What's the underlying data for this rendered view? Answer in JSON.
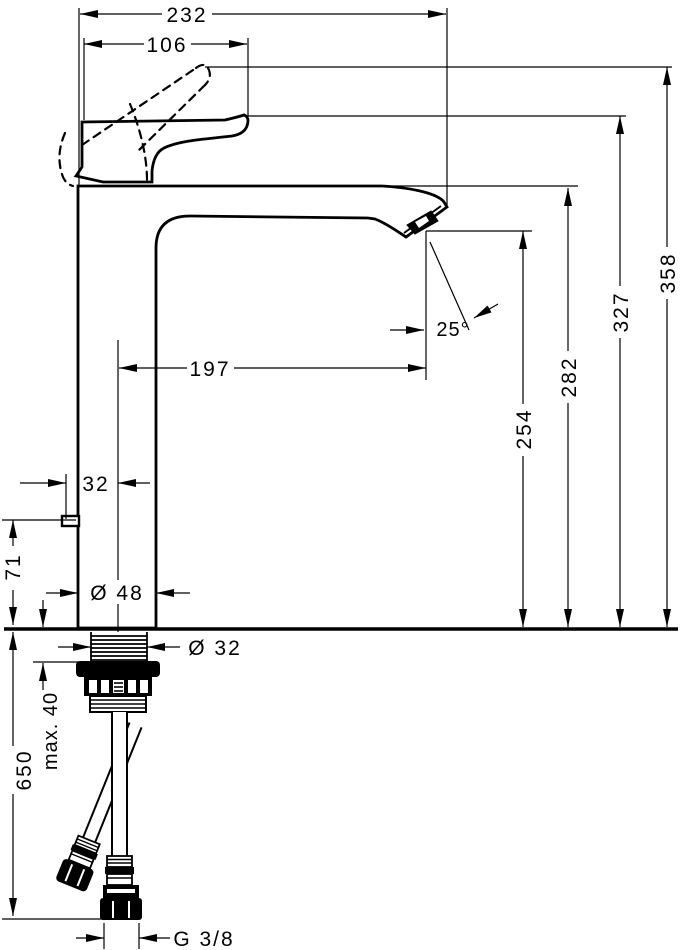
{
  "colors": {
    "ink": "#000000",
    "paper": "#ffffff"
  },
  "dims": {
    "overall_width": "232",
    "handle_reach": "106",
    "spout_reach": "197",
    "spout_angle": "25°",
    "outlet_height": "254",
    "spout_top_height": "282",
    "handle_height": "327",
    "handle_raised_height": "358",
    "rod_offset": "32",
    "body_diameter": "Ø 48",
    "rod_height": "71",
    "shank_diameter": "Ø 32",
    "max_mounting": "max. 40",
    "hose_length": "650",
    "thread": "G 3/8"
  }
}
